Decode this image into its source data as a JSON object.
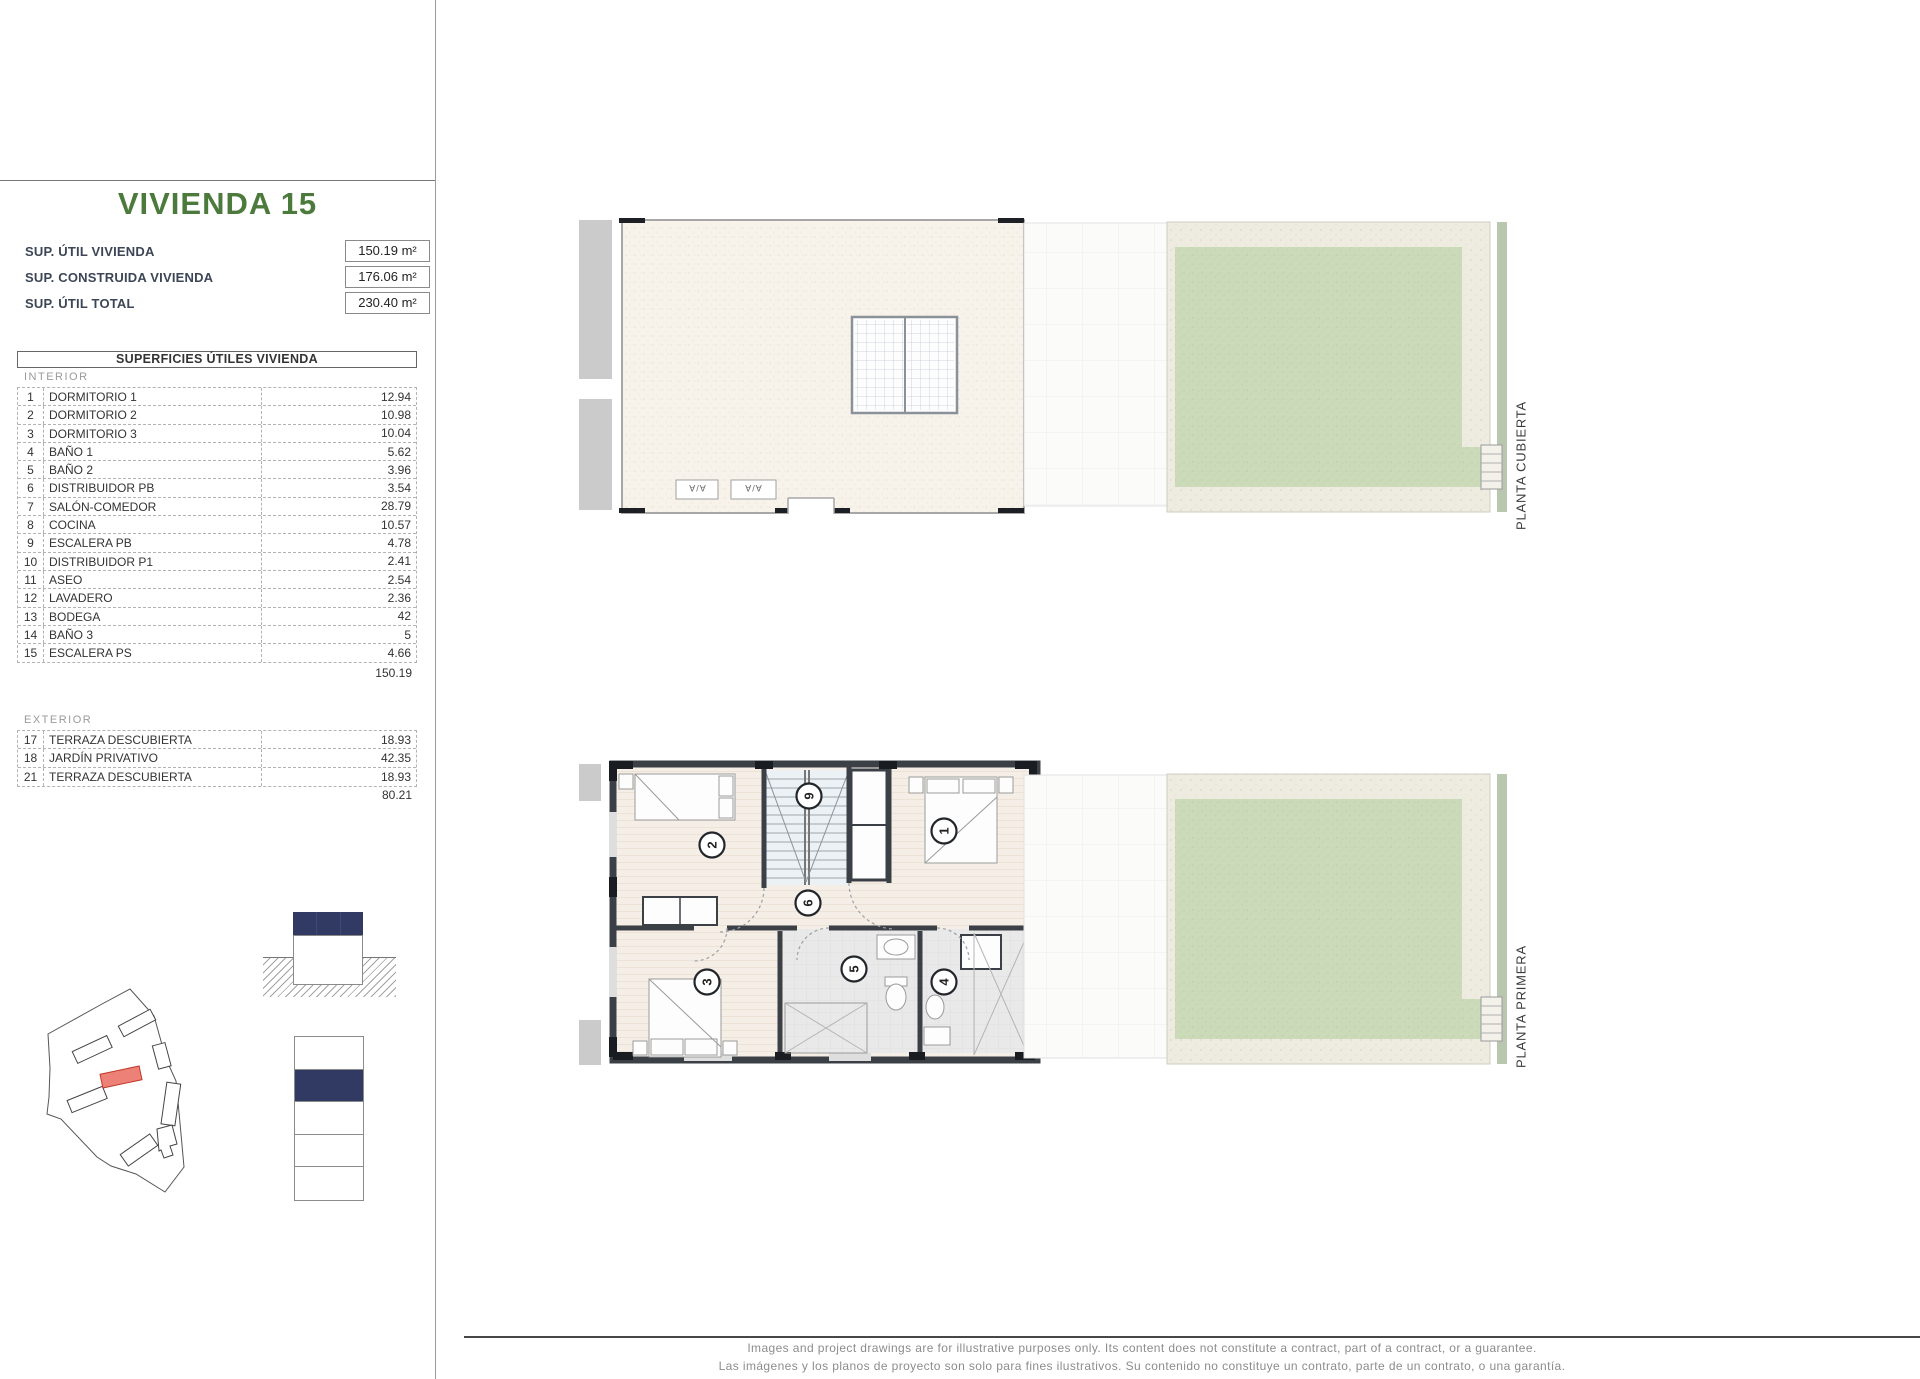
{
  "sidebar": {
    "title": "VIVIENDA 15",
    "summary": [
      {
        "label": "SUP. ÚTIL VIVIENDA",
        "value": "150.19 m²"
      },
      {
        "label": "SUP. CONSTRUIDA VIVIENDA",
        "value": "176.06 m²"
      },
      {
        "label": "SUP. ÚTIL TOTAL",
        "value": "230.40 m²"
      }
    ],
    "table": {
      "header": "SUPERFICIES ÚTILES VIVIENDA",
      "interior_label": "INTERIOR",
      "interior_rows": [
        {
          "num": "1",
          "name": "DORMITORIO 1",
          "value": "12.94"
        },
        {
          "num": "2",
          "name": "DORMITORIO 2",
          "value": "10.98"
        },
        {
          "num": "3",
          "name": "DORMITORIO 3",
          "value": "10.04"
        },
        {
          "num": "4",
          "name": "BAÑO 1",
          "value": "5.62"
        },
        {
          "num": "5",
          "name": "BAÑO 2",
          "value": "3.96"
        },
        {
          "num": "6",
          "name": "DISTRIBUIDOR PB",
          "value": "3.54"
        },
        {
          "num": "7",
          "name": "SALÓN-COMEDOR",
          "value": "28.79"
        },
        {
          "num": "8",
          "name": "COCINA",
          "value": "10.57"
        },
        {
          "num": "9",
          "name": "ESCALERA PB",
          "value": "4.78"
        },
        {
          "num": "10",
          "name": "DISTRIBUIDOR P1",
          "value": "2.41"
        },
        {
          "num": "11",
          "name": "ASEO",
          "value": "2.54"
        },
        {
          "num": "12",
          "name": "LAVADERO",
          "value": "2.36"
        },
        {
          "num": "13",
          "name": "BODEGA",
          "value": "42"
        },
        {
          "num": "14",
          "name": "BAÑO 3",
          "value": "5"
        },
        {
          "num": "15",
          "name": "ESCALERA PS",
          "value": "4.66"
        }
      ],
      "interior_total": "150.19",
      "exterior_label": "EXTERIOR",
      "exterior_rows": [
        {
          "num": "17",
          "name": "TERRAZA DESCUBIERTA",
          "value": "18.93"
        },
        {
          "num": "18",
          "name": "JARDÍN PRIVATIVO",
          "value": "42.35"
        },
        {
          "num": "21",
          "name": "TERRAZA DESCUBIERTA",
          "value": "18.93"
        }
      ],
      "exterior_total": "80.21"
    }
  },
  "plans": {
    "cubierta": {
      "label": "PLANTA CUBIERTA",
      "ac_label": "A/A"
    },
    "primera": {
      "label": "PLANTA PRIMERA",
      "rooms": {
        "r1": "1",
        "r2": "2",
        "r3": "3",
        "r4": "4",
        "r5": "5",
        "r6": "6",
        "r9": "9"
      }
    }
  },
  "footer": {
    "line1": "Images and project drawings are for illustrative purposes only. Its content does not constitute a contract, part of a contract, or a guarantee.",
    "line2": "Las imágenes y los planos de proyecto son solo para fines ilustrativos. Su contenido no constituye un contrato, parte de un contrato, o una garantía."
  },
  "colors": {
    "title_green": "#4b7a3c",
    "accent_navy": "#313a63",
    "highlight_red": "#ee8177",
    "lawn_green": "#cbdab8",
    "wall_dark": "#3b4046"
  }
}
